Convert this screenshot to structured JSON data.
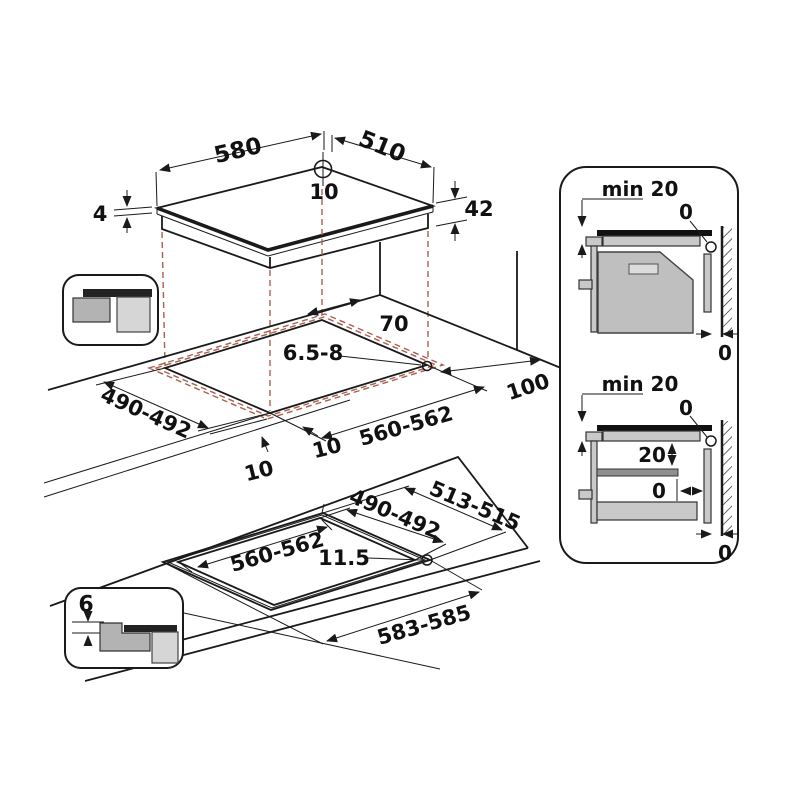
{
  "top_view": {
    "width": "580",
    "depth": "510",
    "hole_offset": "10",
    "glass_thickness": "4",
    "body_height": "42"
  },
  "cutout_view": {
    "hole_back_offset": "70",
    "hole_diameter": "6.5-8",
    "cutout_depth": "490-492",
    "cutout_width": "560-562",
    "side_clearance": "100",
    "overhang_left": "10",
    "overhang_front": "10"
  },
  "flush_view": {
    "outer_depth": "513-515",
    "cutout_depth": "490-492",
    "cutout_width": "560-562",
    "rim_width": "11.5",
    "outer_width": "583-585",
    "recess_depth": "6"
  },
  "clearance_oven": {
    "label_min": "min 20",
    "gap_wall_top": "0",
    "gap_wall_bottom": "0"
  },
  "clearance_drawer": {
    "label_min": "min 20",
    "gap_wall_top": "0",
    "shelf_gap": "20",
    "shelf_side_gap": "0",
    "gap_wall_bottom": "0"
  },
  "colors": {
    "line": "#1a1a1a",
    "projection_dash": "#a9604f",
    "grey_medium": "#b3b3b3",
    "grey_light": "#d6d6d6",
    "grey_body": "#c9c9c9",
    "surface_dark": "#222222"
  }
}
